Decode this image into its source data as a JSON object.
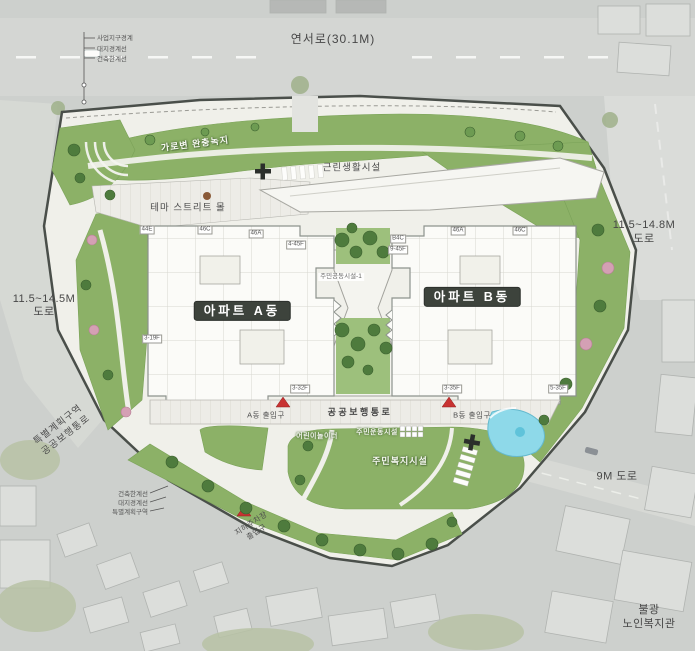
{
  "roads": {
    "top": "연서로(30.1M)",
    "left_line1": "11.5~14.5M",
    "left_line2": "도로",
    "right_line1": "11.5~14.8M",
    "right_line2": "도로",
    "bottom": "9M 도로"
  },
  "legend_top": [
    "사업지구경계",
    "대지경계선",
    "건축한계선"
  ],
  "legend_bottom": [
    "건축한계선",
    "대지경계선",
    "특별계획구역"
  ],
  "site": {
    "green_band": "가로변 완충녹지",
    "theme_street": "테마 스트리트 몰",
    "neighborhood_facility": "근린생활시설",
    "apartment_a": "아파트 A동",
    "apartment_b": "아파트 B동",
    "community_facility": "주민공동시설-1",
    "public_walkway": "공공보행통로",
    "entrance_a": "A동 출입구",
    "entrance_b": "B동 출입구",
    "resident_welfare": "주민복지시설",
    "playground": "어린이놀이터",
    "exercise_area": "주민운동시설",
    "special_zone_line1": "특별계획구역",
    "special_zone_line2": "공공보행통로",
    "parking_line1": "지하주차장",
    "parking_line2": "출입구"
  },
  "neighbors": {
    "bulgwang_line1": "불광",
    "bulgwang_line2": "노인복지관"
  },
  "building_tags": {
    "a": [
      "44E",
      "46C",
      "46A",
      "4-45F",
      "3-19F",
      "3-32F"
    ],
    "b": [
      "B4C",
      "9-45F",
      "46A",
      "46C",
      "3-35F",
      "5-35F"
    ]
  },
  "colors": {
    "site_green": "#8cb167",
    "tree_green": "#4e7b3d",
    "accent_red": "#c83232",
    "water_blue": "#8ed9e9",
    "site_outline": "#4a4f4a"
  }
}
